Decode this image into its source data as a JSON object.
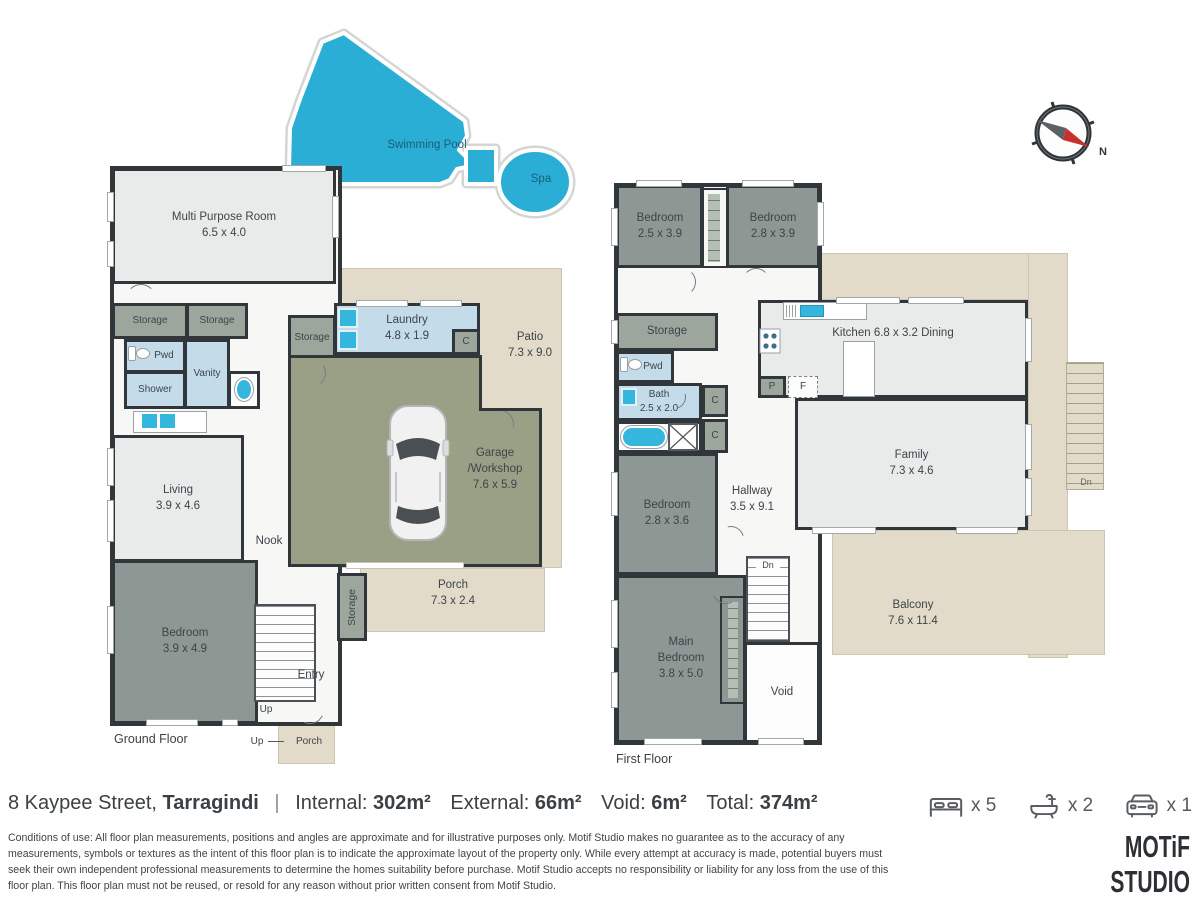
{
  "pool": {
    "label": "Swimming Pool",
    "spa_label": "Spa"
  },
  "compass": {
    "north_label": "N"
  },
  "gf": {
    "floor_label": "Ground Floor",
    "mpr": "Multi Purpose Room\n6.5 x 4.0",
    "storage_a": "Storage",
    "storage_b": "Storage",
    "storage_mid": "Storage",
    "storage_vert": "Storage",
    "pwd": "Pwd",
    "shower": "Shower",
    "vanity": "Vanity",
    "living": "Living\n3.9 x 4.6",
    "nook": "Nook",
    "bedroom": "Bedroom\n3.9 x 4.9",
    "entry": "Entry",
    "up": "Up",
    "up_small": "Up",
    "laundry": "Laundry\n4.8 x 1.9",
    "closet": "C",
    "garage": "Garage\n/Workshop\n7.6 x 5.9",
    "patio": "Patio\n7.3 x 9.0",
    "porch": "Porch\n7.3 x 2.4",
    "porch_small": "Porch"
  },
  "ff": {
    "floor_label": "First Floor",
    "bedroom1": "Bedroom\n2.5 x 3.9",
    "bedroom2": "Bedroom\n2.8 x 3.9",
    "storage": "Storage",
    "pwd": "Pwd",
    "bath": "Bath\n2.5 x 2.0",
    "closet1": "C",
    "closet2": "C",
    "kitchen": "Kitchen   6.8 x 3.2   Dining",
    "pantry": "P",
    "fridge": "F",
    "hallway": "Hallway\n3.5 x 9.1",
    "family": "Family\n7.3 x 4.6",
    "bedroom3": "Bedroom\n2.8 x 3.6",
    "main_bedroom": "Main\nBedroom\n3.8 x 5.0",
    "void": "Void",
    "balcony": "Balcony\n7.6 x 11.4",
    "dn_internal": "Dn",
    "dn_external": "Dn"
  },
  "footer": {
    "address": {
      "street": "8 Kaypee Street,",
      "suburb": "Tarragindi",
      "separator": "|",
      "internal_label": "Internal:",
      "internal_value": "302m²",
      "external_label": "External:",
      "external_value": "66m²",
      "void_label": "Void:",
      "void_value": "6m²",
      "total_label": "Total:",
      "total_value": "374m²"
    },
    "stats": {
      "beds": "x 5",
      "baths": "x 2",
      "cars": "x 1"
    },
    "disclaimer": "Conditions of use: All floor plan measurements, positions and angles are approximate and for illustrative purposes only. Motif Studio makes no guarantee as to the accuracy of any measurements, symbols or textures as the intent of this floor plan is to indicate the approximate layout of the property only. While every attempt at accuracy is made, potential buyers must seek their own independent professional measurements to determine the homes suitability before purchase. Motif Studio accepts no responsibility or liability for any loss from the use of this floor plan. This floor plan must not be reused, or resold for any reason without prior written consent from Motif Studio.",
    "logo": "MOTiF STUDIO"
  },
  "colors": {
    "pool": "#2aaed6",
    "beige": "#e2dbc9",
    "garage": "#9aa086",
    "room_light": "#e9ebea",
    "room_dark": "#8d9793",
    "storage": "#9ca69d",
    "tile": "#c4dcea",
    "wall": "#30363a",
    "fixture": "#35b6dc"
  }
}
